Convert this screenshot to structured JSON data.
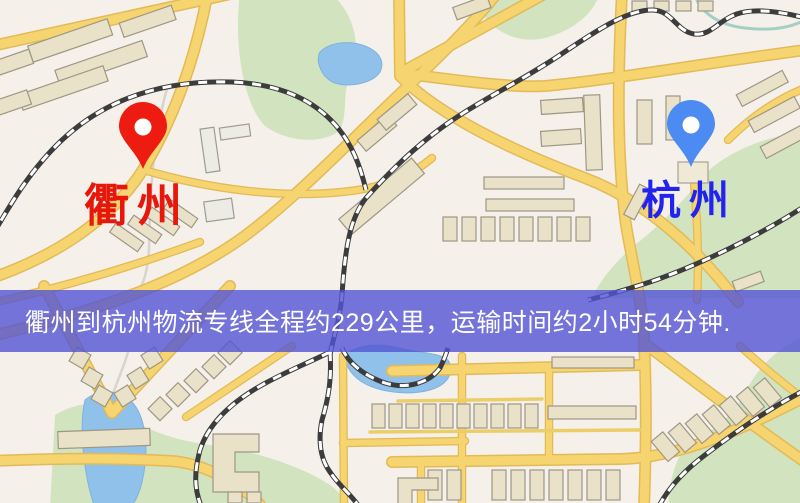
{
  "map": {
    "origin": {
      "label": "衢州"
    },
    "destination": {
      "label": "杭州"
    },
    "banner": {
      "text": "衢州到杭州物流专线全程约229公里，运输时间约2小时54分钟."
    },
    "icons": {
      "origin_pin": "map-pin-icon",
      "destination_pin": "map-pin-icon"
    },
    "colors": {
      "background": "#f5f0ea",
      "road": "#f6d470",
      "road_casing": "#e2ba58",
      "building_fill": "#e9e1c8",
      "building_stroke": "#9e9785",
      "park": "#d2e3c0",
      "water": "#8fc1ea",
      "railway": "#3c3c3c",
      "banner_bg": "rgba(82,84,213,0.8)",
      "banner_text": "#ffffff",
      "origin_pin": "#ee1b10",
      "origin_label": "#e8170c",
      "dest_pin": "#4b8bf2",
      "dest_label": "#2323ef"
    }
  }
}
